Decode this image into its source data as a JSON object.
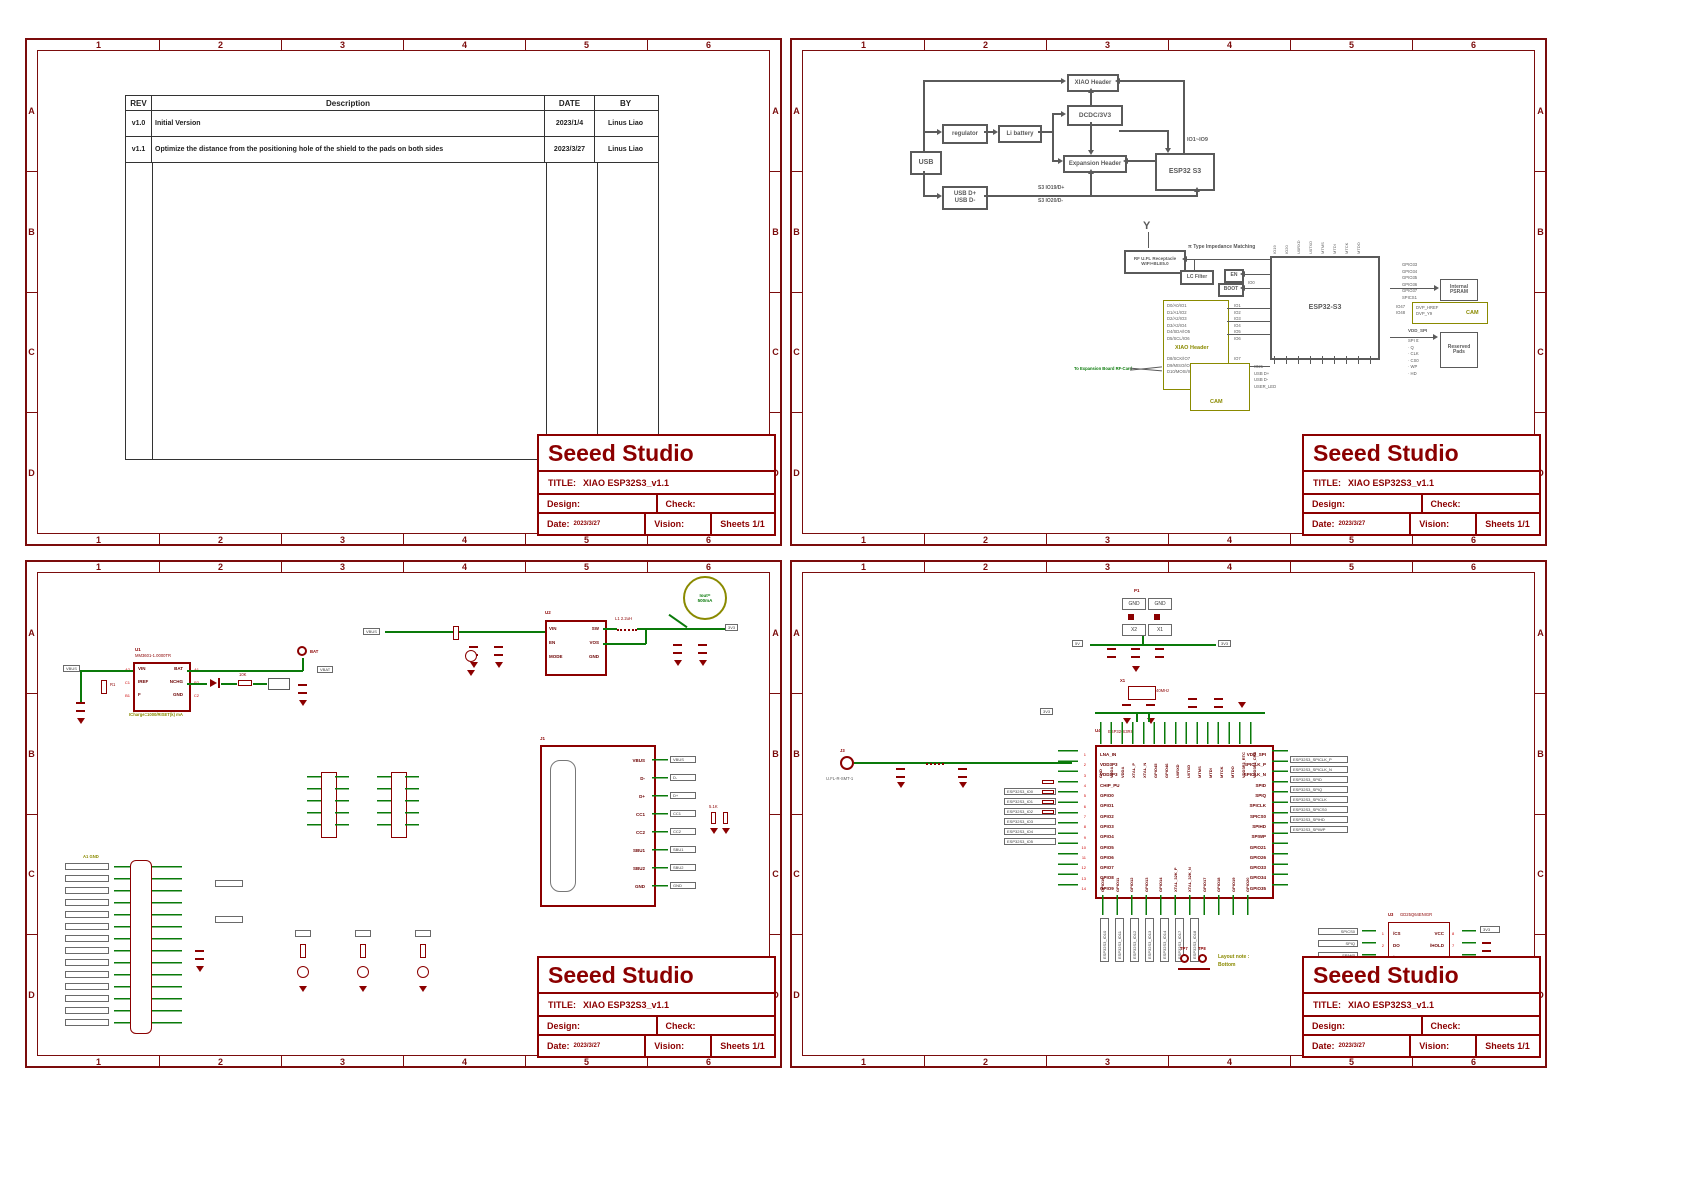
{
  "frame": {
    "cols": [
      "1",
      "2",
      "3",
      "4",
      "5",
      "6"
    ],
    "rows": [
      "A",
      "B",
      "C",
      "D"
    ]
  },
  "title_block": {
    "company": "Seeed Studio",
    "title_label": "TITLE:",
    "title": "XIAO ESP32S3_v1.1",
    "design_label": "Design:",
    "check_label": "Check:",
    "date_label": "Date:",
    "date": "2023/3/27",
    "vision_label": "Vision:",
    "sheets_label": "Sheets 1/1"
  },
  "rev_table": {
    "headers": [
      "REV",
      "Description",
      "DATE",
      "BY"
    ],
    "rows": [
      {
        "rev": "v1.0",
        "desc": "Initial Version",
        "date": "2023/1/4",
        "by": "Linus Liao"
      },
      {
        "rev": "v1.1",
        "desc": "Optimize the distance from the positioning hole of the shield to the pads on both sides",
        "date": "2023/3/27",
        "by": "Linus Liao"
      }
    ]
  },
  "block_diagram": {
    "usb": "USB",
    "regulator": "regulator",
    "li_battery": "Li battery",
    "usb_pins": "USB D+\nUSB D-",
    "xiao_header": "XIAO Header",
    "dcdc": "DCDC/3V3",
    "expansion_header": "Expansion Header",
    "esp32": "ESP32 S3",
    "net_dp": "S3 IO19/D+",
    "net_dm": "S3 IO20/D-",
    "io_bus": "IO1~IO9"
  },
  "rf": {
    "receptacle": "RF U.FL Receptacle\nWIFI+BLE5.0",
    "matching": "π Type Impedance Matching",
    "lc_filter": "LC Filter",
    "en": "EN",
    "boot": "BOOT",
    "io0": "IO0",
    "chip": "ESP32-S3",
    "antenna": "Y",
    "top_pins": [
      "IO19",
      "IO20",
      "U0RXD",
      "U0TXD",
      "MTMS",
      "MTDI",
      "MTCK",
      "MTDO"
    ],
    "xiao_header": "XIAO Header",
    "xiao_signals": [
      "D0/A0/IO1",
      "D1/A1/IO2",
      "D2/A2/IO3",
      "D3/A3/IO4",
      "D4/SDA/IO5",
      "D5/SCL/IO6"
    ],
    "xiao_signals2": [
      "D8/SCK/IO7",
      "D9/MISO/IO8",
      "D10/MOSI/IO9"
    ],
    "xiao_pins": [
      "IO1",
      "IO2",
      "IO3",
      "IO4",
      "IO5",
      "IO6"
    ],
    "xiao_pins2": [
      "IO7",
      "IO8",
      "IO9"
    ],
    "to_expansion": "To Expansion Board RF-Card",
    "psram_signals": [
      "GPIO33",
      "GPIO34",
      "GPIO35",
      "GPIO36",
      "GPIO37",
      "SPICS1"
    ],
    "psram": "Internal\nPSRAM",
    "cam_ios": "IO47\nIO48",
    "cam_signals": "DVP_HREF\nDVP_Y9",
    "cam_tag": "CAM",
    "vdd_spi": "VDD_SPI",
    "spi_pins": [
      "SPI 0:",
      "· Q",
      "· CLK",
      "· CS0",
      "· WP",
      "· HD"
    ],
    "reserved": "Reserved\nPads",
    "cam_box": "CAM",
    "bottom_labels": [
      "IO21",
      "USB D+",
      "USB D-",
      "USER_LED"
    ]
  },
  "power": {
    "charger": {
      "ref": "U1",
      "part": "MM3601-1.0000TR",
      "des_left": [
        "A2",
        "C1",
        "B1"
      ],
      "pins_left": [
        "VIN",
        "IREF",
        "F"
      ],
      "des_right": [
        "A1",
        "B2",
        "C2"
      ],
      "pins_right": [
        "BAT",
        "NCHG",
        "GND"
      ],
      "note": "ICharge=1000/RISET(k) mA",
      "r1": "R1",
      "rval": "10K",
      "in_flag": "VBUS"
    },
    "bat_tp": "BAT",
    "vbat": "VBAT",
    "gnd": "GND",
    "iout": "Iout=\n500mA",
    "reg": {
      "ref": "U2",
      "pins_left": [
        "VIN",
        "EN",
        "MODE"
      ],
      "pins_right": [
        "SW",
        "VOS",
        "GND"
      ],
      "l1": "L1 2.2uH",
      "out": "3V3",
      "in_flag": "VBUS"
    },
    "usb_conn": {
      "ref": "J1",
      "pins": [
        "VBUS",
        "D-",
        "D+",
        "CC1",
        "CC2",
        "SBU1",
        "SBU2",
        "GND"
      ],
      "rcc": "5.1K"
    },
    "tps": [
      {
        "tp": "TP1",
        "net": "ESP32S3_MTMS"
      },
      {
        "tp": "TP2",
        "net": "ESP32S3_MTDI"
      },
      {
        "tp": "TP3",
        "net": "ESP32S3_MTCK_CLK"
      },
      {
        "tp": "TP4",
        "net": "ESP32S3_MTDO"
      },
      {
        "tp": "TP5",
        "net": "ESP32S3_U0TXD"
      },
      {
        "tp": "TP6",
        "net": "ESP32S3_U0RXD"
      }
    ],
    "layout_note": "Layout note:\nSame position as XIAO-C3",
    "pads_note": "A1 GND"
  },
  "mcu_sheet": {
    "pads": {
      "ref": "P1",
      "labels": [
        "GND",
        "GND",
        "X2",
        "X1"
      ]
    },
    "v5": "5V",
    "v33": "3V3",
    "xtal": {
      "ref": "X1",
      "val": "40MHz"
    },
    "ufl": {
      "ref": "J3",
      "part": "U.FL-R-SMT-1"
    },
    "mcu": {
      "ref": "U4",
      "part": "ESP32-S3R8",
      "left_pins": [
        [
          "1",
          "LNA_IN"
        ],
        [
          "2",
          "VDD3P3"
        ],
        [
          "3",
          "VDD3P3"
        ],
        [
          "4",
          "CHIP_PU"
        ],
        [
          "5",
          "GPIO0"
        ],
        [
          "6",
          "GPIO1"
        ],
        [
          "7",
          "GPIO2"
        ],
        [
          "8",
          "GPIO3"
        ],
        [
          "9",
          "GPIO4"
        ],
        [
          "10",
          "GPIO5"
        ],
        [
          "11",
          "GPIO6"
        ],
        [
          "12",
          "GPIO7"
        ],
        [
          "13",
          "GPIO8"
        ],
        [
          "14",
          "GPIO9"
        ]
      ],
      "top_pins": [
        "GND",
        "VDDA",
        "VDDA",
        "XTAL_P",
        "XTAL_N",
        "GPIO45",
        "GPIO46",
        "U0RXD",
        "U0TXD",
        "MTMS",
        "MTDI",
        "MTCK",
        "MTDO",
        "VDD3P3_RTC",
        "VDD3P3_CPU"
      ],
      "right_pins": [
        "VDD_SPI",
        "SPICLK_P",
        "SPICLK_N",
        "SPID",
        "SPIQ",
        "SPICLK",
        "SPICS0",
        "SPIHD",
        "SPIWP",
        "GPIO21",
        "GPIO26",
        "GPIO33",
        "GPIO34",
        "GPIO35"
      ],
      "bottom_pins": [
        "GPIO10",
        "GPIO11",
        "GPIO12",
        "GPIO13",
        "GPIO14",
        "XTAL_32K_P",
        "XTAL_32K_N",
        "GPIO17",
        "GPIO18",
        "GPIO19",
        "GPIO20"
      ]
    },
    "left_flags": [
      "ESP32S3_IO0",
      "ESP32S3_IO1",
      "ESP32S3_IO2",
      "ESP32S3_IO3",
      "ESP32S3_IO4",
      "ESP32S3_IO5"
    ],
    "right_flags": [
      "ESP32S3_SPICLK_P",
      "ESP32S3_SPICLK_N",
      "ESP32S3_SPID",
      "ESP32S3_SPIQ",
      "ESP32S3_SPICLK",
      "ESP32S3_SPICS0",
      "ESP32S3_SPIHD",
      "ESP32S3_SPIWP"
    ],
    "bottom_flags": [
      "ESP32S3_IO10",
      "ESP32S3_IO11",
      "ESP32S3_IO12",
      "ESP32S3_IO13",
      "ESP32S3_IO14",
      "ESP32S3_IO17",
      "ESP32S3_IO18"
    ],
    "tps": [
      "TP7",
      "TP8"
    ],
    "layout_note": "Layout note :\nBottom",
    "flash": {
      "ref": "U3",
      "part": "GD25Q64ENIGR",
      "pins_left": [
        [
          "1",
          "/CS"
        ],
        [
          "2",
          "DO"
        ],
        [
          "3",
          "/WP"
        ],
        [
          "4",
          "GND"
        ]
      ],
      "pins_right": [
        [
          "8",
          "VCC"
        ],
        [
          "7",
          "/HOLD"
        ],
        [
          "6",
          "CLK"
        ],
        [
          "5",
          "DI"
        ]
      ],
      "caption": "8MB Flash  GD25Q64ENIGR",
      "flags_left": [
        "SPICS0",
        "SPIQ",
        "SPIWP"
      ],
      "flags_right": [
        "SPID",
        "SPICLK"
      ],
      "pwr": "3V3"
    }
  }
}
